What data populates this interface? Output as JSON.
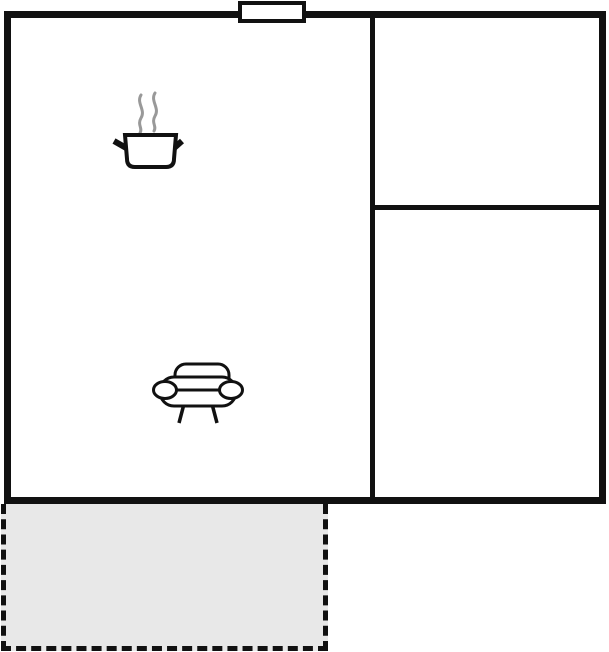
{
  "floorplan": {
    "rooms": {
      "living_kitchen": {
        "icons": [
          {
            "name": "cooking-pot-icon"
          },
          {
            "name": "sofa-icon"
          }
        ]
      },
      "bathroom": {
        "icons": [
          {
            "name": "water-drop-icon"
          }
        ]
      },
      "bedroom": {
        "label": "1"
      },
      "terrace": {
        "style": "dashed-outline"
      }
    },
    "features": {
      "window_marker": "window-icon"
    },
    "colors": {
      "wall": "#111111",
      "water_drop_fill": "#b2f3f1",
      "terrace_fill": "#e8e8e8",
      "steam": "#999999",
      "background": "#ffffff"
    }
  }
}
